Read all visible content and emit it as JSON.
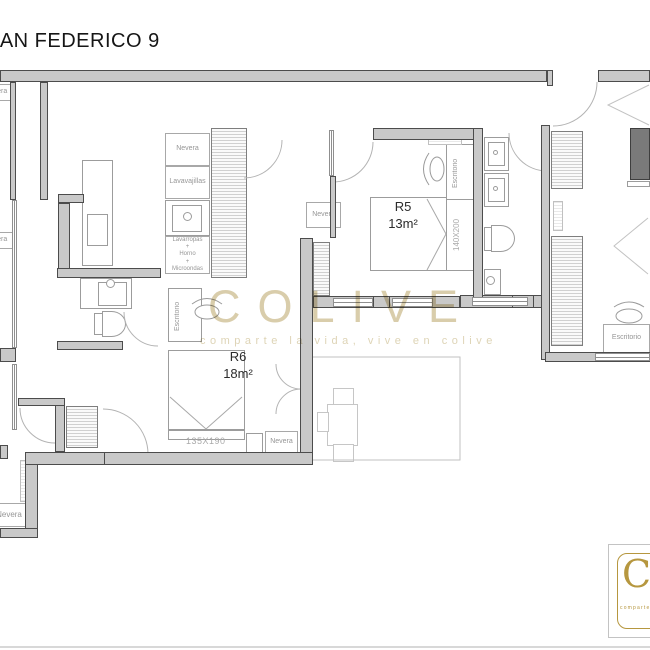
{
  "title": "SAN FEDERICO 9",
  "kitchen": {
    "nevera": "Nevera",
    "lavavajillas": "Lavavajillas",
    "appliance_stack": "Lavarropas\n+\nHorno\n+\nMicroondas"
  },
  "rooms": {
    "r5": {
      "name": "R5",
      "area": "13m²",
      "bed_size": "140X200",
      "desk": "Escritorio"
    },
    "r6": {
      "name": "R6",
      "area": "18m²",
      "bed_size": "135X190",
      "desk": "Escritorio",
      "nevera": "Nevera"
    }
  },
  "corridor": {
    "nevera": "Nevera"
  },
  "right_room": {
    "desk": "Escritorio"
  },
  "edge": {
    "nevera": "Nevera"
  },
  "watermark": {
    "brand": "COLIVE",
    "tagline": "comparte la vida, vive en colive"
  },
  "logo": {
    "initial": "C",
    "tagline": "comparte la vida"
  },
  "colors": {
    "wall_fill": "#c9c9c9",
    "wall_outline": "#4c4c4c",
    "furniture_line": "#9c9c9c",
    "watermark": "#d9cdab",
    "logo_gold": "#b6973f"
  }
}
